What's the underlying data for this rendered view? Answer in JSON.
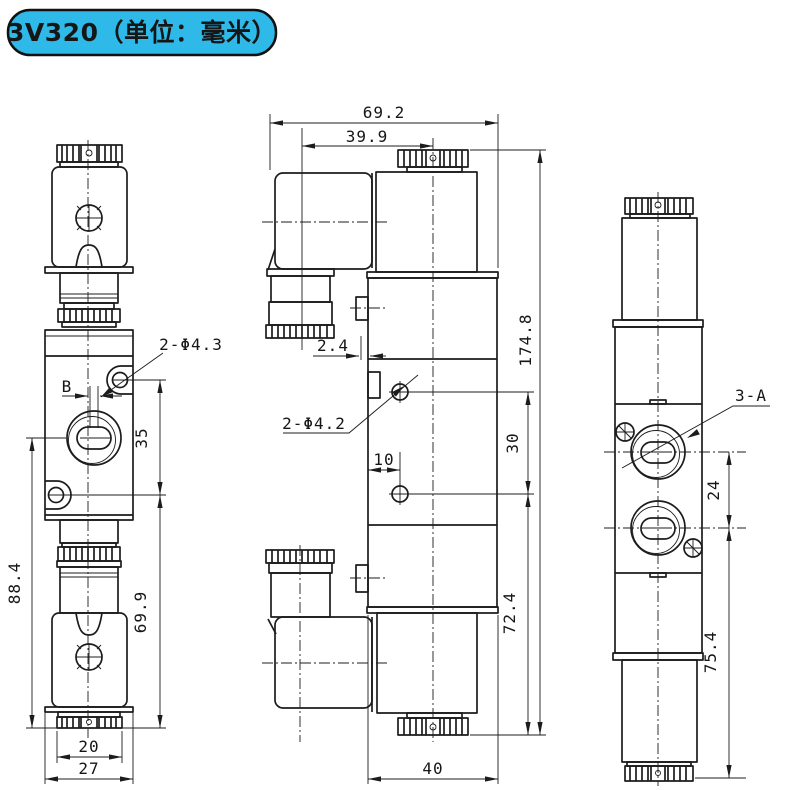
{
  "badge": {
    "text": "3V320（单位：毫米）",
    "bg_color": "#2fb9e9",
    "border_color": "#111111"
  },
  "ink_color": "#1c1c1c",
  "front_view": {
    "label_holes": "2-Φ4.3",
    "label_b": "B",
    "dim_35": "35",
    "dim_88_4": "88.4",
    "dim_69_9": "69.9",
    "dim_20": "20",
    "dim_27": "27"
  },
  "side_view": {
    "dim_69_2": "69.2",
    "dim_39_9": "39.9",
    "dim_2_4": "2.4",
    "label_holes": "2-Φ4.2",
    "dim_10": "10",
    "dim_30": "30",
    "dim_174_8": "174.8",
    "dim_72_4": "72.4",
    "dim_40": "40"
  },
  "end_view": {
    "label_ports": "3-A",
    "dim_24": "24",
    "dim_75_4": "75.4"
  }
}
